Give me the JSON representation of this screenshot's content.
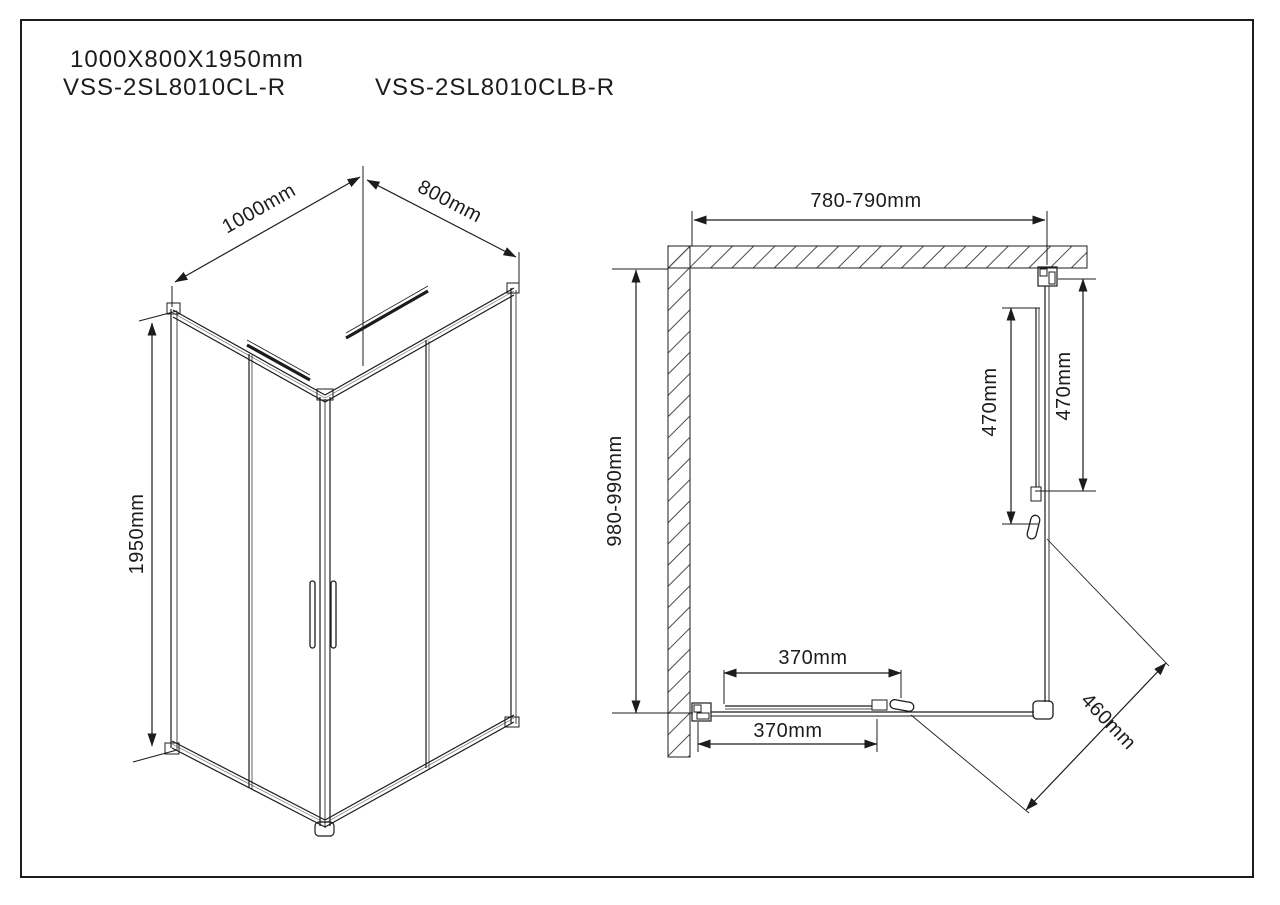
{
  "page": {
    "size_label": "1000X800X1950mm",
    "model_left": "VSS-2SL8010CL-R",
    "model_right": "VSS-2SL8010CLB-R"
  },
  "iso_view": {
    "width_label": "1000mm",
    "depth_label": "800mm",
    "height_label": "1950mm"
  },
  "plan_view": {
    "top_width_label": "780-790mm",
    "left_depth_label": "980-990mm",
    "right_fixed_panel_label": "470mm",
    "right_door_label": "470mm",
    "bottom_door_label": "370mm",
    "bottom_fixed_panel_label": "370mm",
    "corner_opening_label": "460mm"
  },
  "colors": {
    "line": "#1c1c1c",
    "background": "#ffffff"
  }
}
